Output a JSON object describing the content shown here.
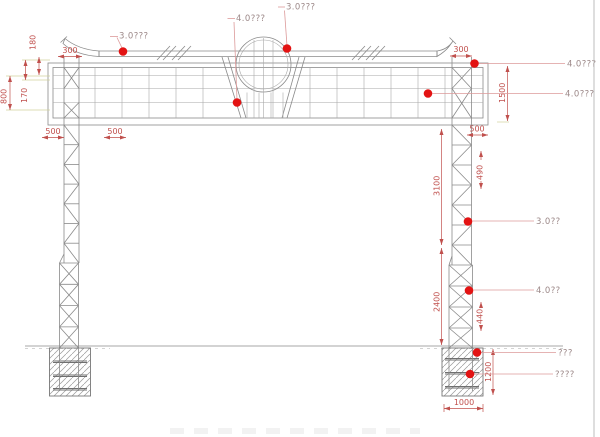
{
  "callouts": {
    "band_left": "3.0???",
    "emblem_base": "4.0???",
    "emblem_side": "3.0???",
    "board_corner": "4.0???",
    "board_inner": "4.0???",
    "column_upper": "3.0??",
    "column_lower": "4.0??",
    "foundation_upper": "???",
    "foundation_lower": "????"
  },
  "dimensions": {
    "eave_height": "180",
    "eave_offset_left": "300",
    "board_left_total": "800",
    "board_left_inner": "170",
    "panel_left_a": "500",
    "panel_left_b": "500",
    "eave_offset_right": "300",
    "board_height": "1500",
    "panel_right": "500",
    "column_upper_height": "3100",
    "column_brace": "490",
    "column_lower_height": "2400",
    "column_base": "440",
    "foundation_depth": "1200",
    "foundation_width": "1000"
  },
  "colors": {
    "drawing_line": "#8a8a8a",
    "dimension_red": "#c0504d",
    "callout_label": "#9c8888",
    "marker_dot": "#e31313",
    "leader_line": "#dc9a9a",
    "extension_line": "#d2d29c"
  }
}
